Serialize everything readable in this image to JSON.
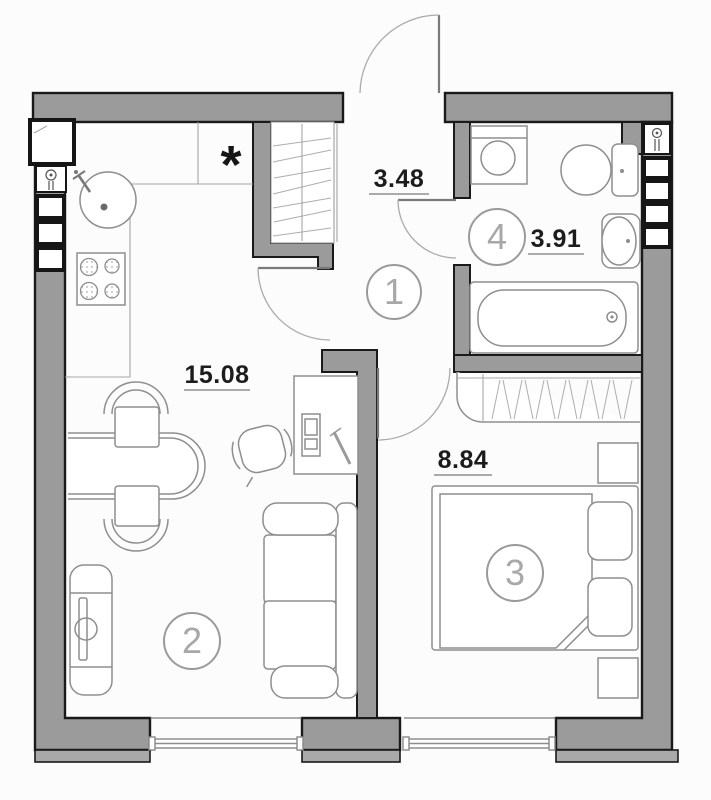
{
  "plan": {
    "rooms": [
      {
        "number": "1",
        "area": "3.48",
        "name": "hallway"
      },
      {
        "number": "2",
        "area": "15.08",
        "name": "kitchen-living-room"
      },
      {
        "number": "3",
        "area": "8.84",
        "name": "bedroom"
      },
      {
        "number": "4",
        "area": "3.91",
        "name": "bathroom"
      }
    ],
    "symbols": {
      "gas_marker": "*"
    },
    "colors": {
      "wall_fill": "#9b9b9b",
      "wall_outline": "#1a1a1a",
      "fixture_line": "#8e8e8e",
      "area_text": "#1c1c1c",
      "room_number_text": "#a8a8a8",
      "background": "#fcfcfc"
    },
    "fixtures": [
      "entrance-door",
      "hall-closet",
      "washing-machine",
      "toilet",
      "bathroom-sink",
      "bathtub",
      "kitchen-counter",
      "kitchen-sink",
      "stove",
      "dining-table",
      "dining-chair",
      "tv-stand",
      "desk",
      "office-chair",
      "sofa",
      "wardrobe",
      "bed",
      "nightstand",
      "window",
      "ventilation-shaft"
    ]
  }
}
